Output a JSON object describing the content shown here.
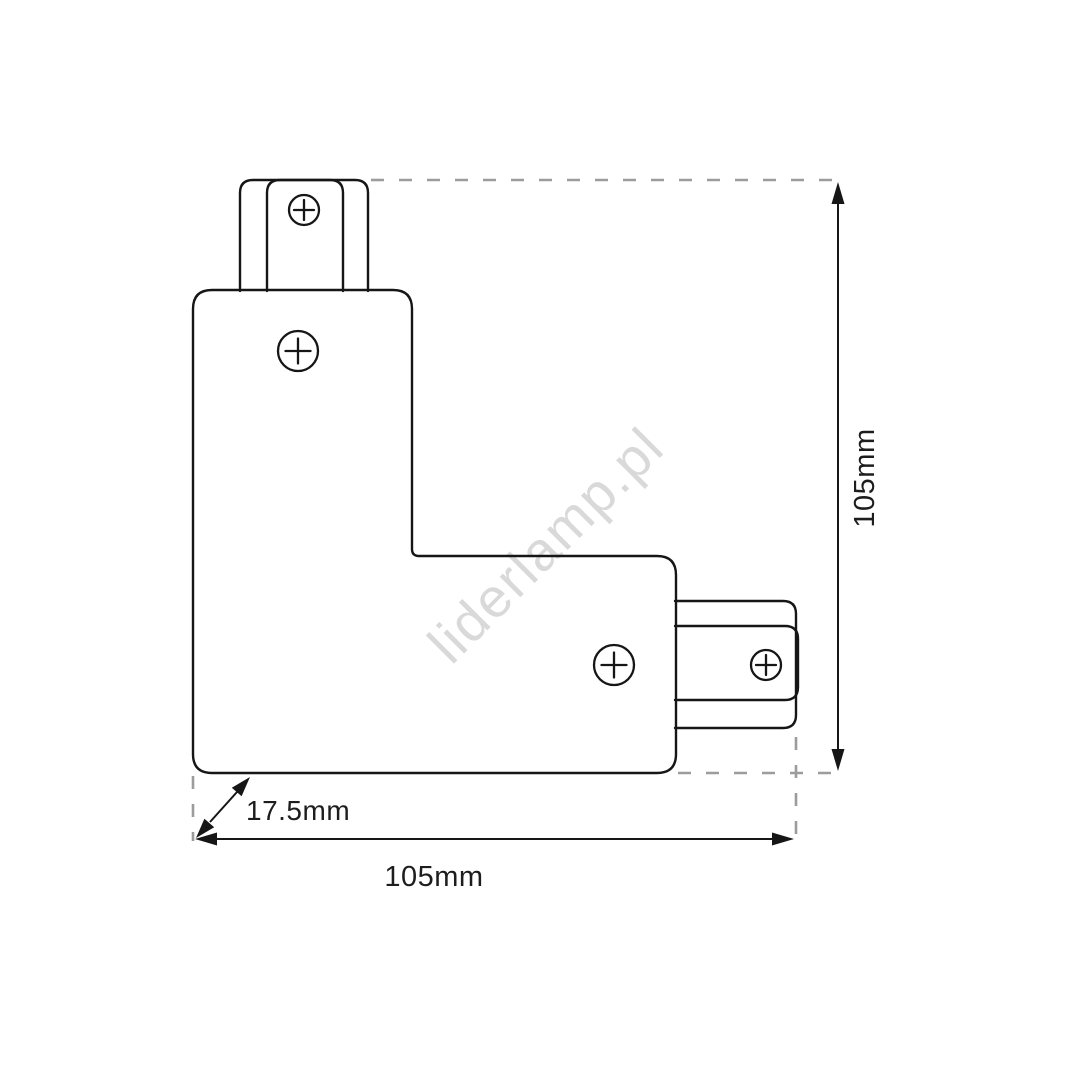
{
  "drawing": {
    "watermark": "liderlamp.pl",
    "labels": {
      "height": "105mm",
      "width": "105mm",
      "depth": "17.5mm"
    },
    "colors": {
      "line": "#161616",
      "dashed_line": "#9c9c9c",
      "label_text": "#1d1d1d",
      "watermark": "#d9d9d9",
      "background": "#ffffff"
    },
    "icons": {
      "screw": "circle-plus-screw-icon",
      "dimension_arrow": "filled-triangle-arrowhead"
    }
  }
}
